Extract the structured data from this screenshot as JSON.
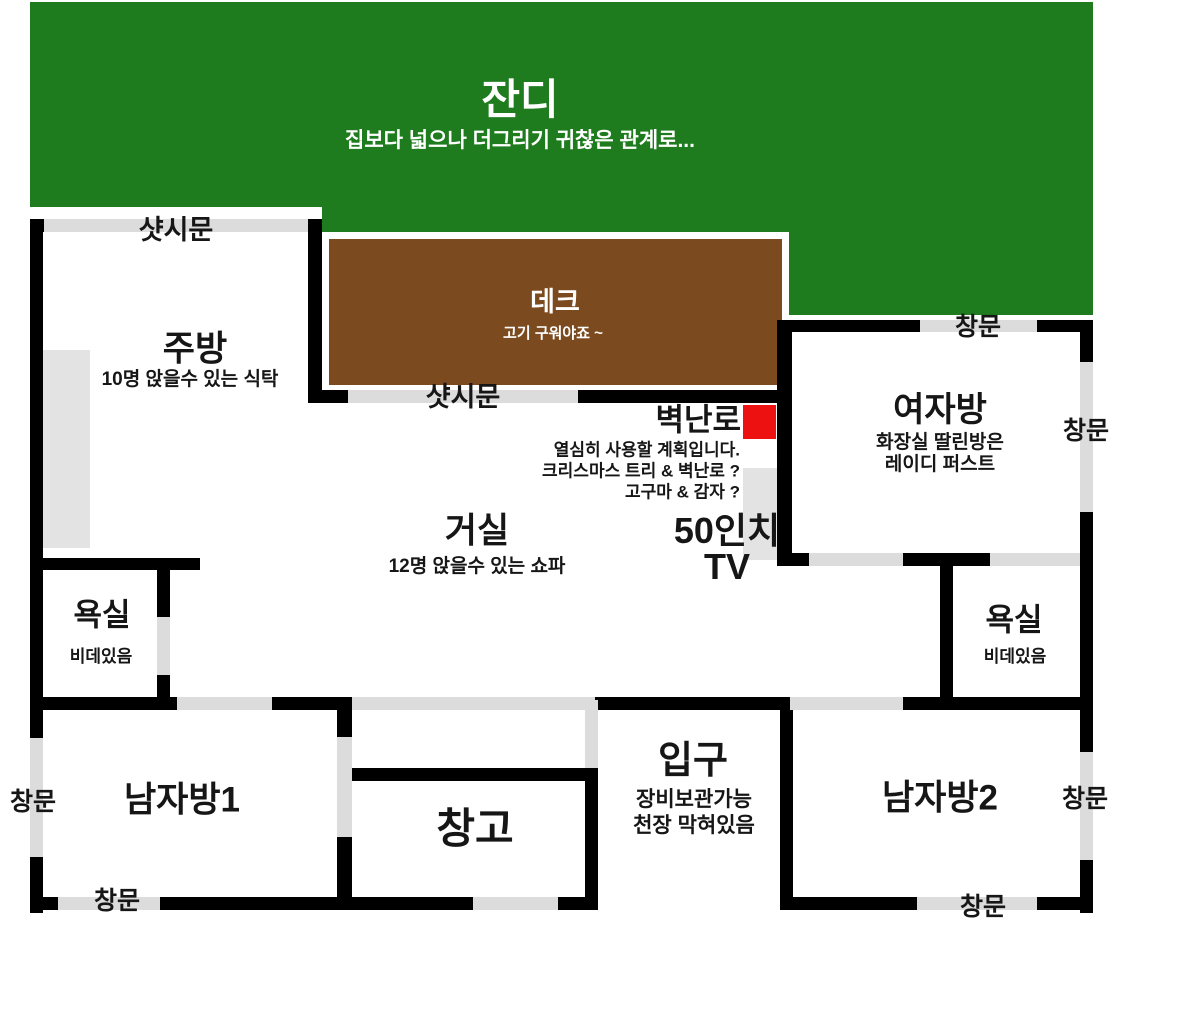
{
  "colors": {
    "lawn": "#1e7c1e",
    "deck": "#7b4a1f",
    "wall": "#000000",
    "opening": "#dcdcdc",
    "furniture": "#e3e3e3",
    "fireplace": "#ee1111",
    "text": "#161616",
    "text_light": "#ffffff"
  },
  "outdoor": {
    "lawn": {
      "label": "잔디",
      "note": "집보다 넓으나 더그리기 귀찮은 관계로..."
    },
    "deck": {
      "label": "데크",
      "note": "고기 구워야죠 ~"
    }
  },
  "rooms": {
    "kitchen": {
      "label": "주방",
      "note": "10명 앉을수 있는 식탁"
    },
    "living": {
      "label": "거실",
      "note": "12명 앉을수 있는 쇼파"
    },
    "woman_room": {
      "label": "여자방",
      "note1": "화장실 딸린방은",
      "note2": "레이디 퍼스트"
    },
    "bath_left": {
      "label": "욕실",
      "note": "비데있음"
    },
    "bath_right": {
      "label": "욕실",
      "note": "비데있음"
    },
    "man_room1": {
      "label": "남자방1"
    },
    "man_room2": {
      "label": "남자방2"
    },
    "storage": {
      "label": "창고"
    },
    "entrance": {
      "label": "입구",
      "note1": "장비보관가능",
      "note2": "천장 막혀있음"
    }
  },
  "features": {
    "fireplace": {
      "label": "벽난로",
      "notes": [
        "열심히 사용할 계획입니다.",
        "크리스마스 트리 & 벽난로 ?",
        "고구마 & 감자 ?"
      ]
    },
    "tv": {
      "line1": "50인치",
      "line2": "TV"
    }
  },
  "openings": {
    "sash_door": "샷시문",
    "window": "창문"
  }
}
